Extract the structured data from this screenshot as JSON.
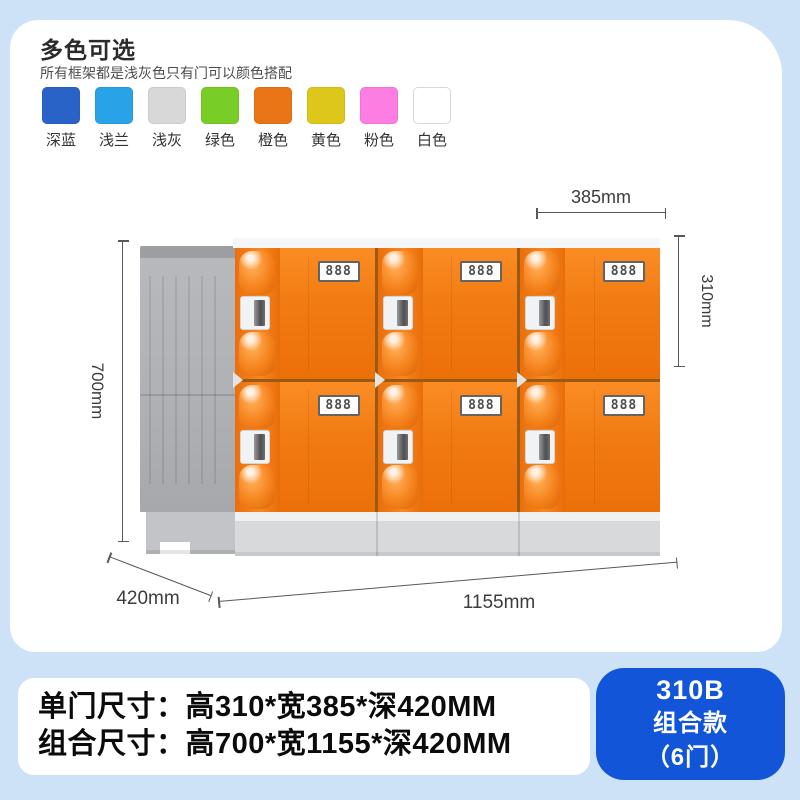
{
  "page": {
    "background": "#cee2f7"
  },
  "header": {
    "title": "多色可选",
    "subtitle": "所有框架都是浅灰色只有门可以颜色搭配"
  },
  "color_options": [
    {
      "label": "深蓝",
      "hex": "#2a63c8"
    },
    {
      "label": "浅兰",
      "hex": "#29a3e8"
    },
    {
      "label": "浅灰",
      "hex": "#d8d8d8"
    },
    {
      "label": "绿色",
      "hex": "#79cd27"
    },
    {
      "label": "橙色",
      "hex": "#ea7517"
    },
    {
      "label": "黄色",
      "hex": "#ddc71a"
    },
    {
      "label": "粉色",
      "hex": "#fc7ee2"
    },
    {
      "label": "白色",
      "hex": "#ffffff"
    }
  ],
  "locker": {
    "rows": 2,
    "columns": 3,
    "door_label": "888",
    "door_color": "#f5811c",
    "frame_color": "#b8b9bd"
  },
  "dimensions": {
    "single_door_width": "385mm",
    "single_door_height": "310mm",
    "total_height": "700mm",
    "depth": "420mm",
    "total_width": "1155mm"
  },
  "specs": {
    "line1": "单门尺寸：高310*宽385*深420MM",
    "line2": "组合尺寸：高700*宽1155*深420MM"
  },
  "badge": {
    "bg": "#1355d8",
    "line1": "310B",
    "line2": "组合款",
    "line3": "（6门）"
  }
}
